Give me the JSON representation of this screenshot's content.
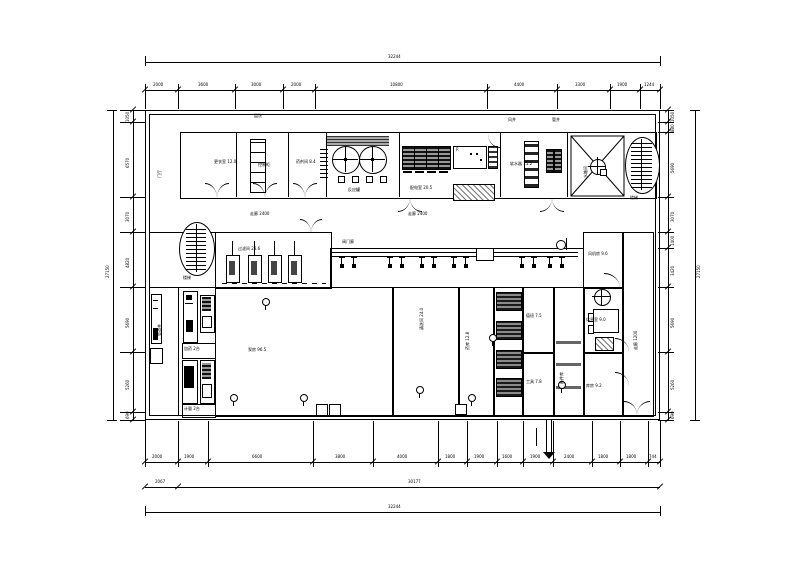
{
  "drawing": {
    "colors": {
      "line": "#000000",
      "hatch_dark": "#444444",
      "hatch_gray": "#999999",
      "fill_black": "#111111"
    },
    "dim_top": {
      "overall": "32244",
      "segments": [
        "2000",
        "3600",
        "3000",
        "2000",
        "10800",
        "4400",
        "3300",
        "1900",
        "1244"
      ]
    },
    "dim_bottom": {
      "overall": "32244",
      "tier2": [
        "2067",
        "30177"
      ],
      "segments": [
        "2000",
        "1900",
        "6600",
        "3800",
        "4000",
        "1800",
        "1900",
        "1600",
        "1900",
        "2400",
        "1800",
        "1800",
        "744"
      ]
    },
    "dim_left": {
      "overall": "27150",
      "segments": [
        "1050",
        "6570",
        "3070",
        "4820",
        "5690",
        "5260",
        "690"
      ]
    },
    "dim_right": {
      "overall": "27150",
      "segments": [
        "1050",
        "880",
        "5690",
        "3070",
        "1400",
        "3420",
        "5690",
        "5260",
        "690"
      ]
    },
    "labels": {
      "t1": "盥洗",
      "t2": "风井",
      "t3": "管井",
      "r1": "更衣室 12.0",
      "r2": "控制柜",
      "r3": "药剂间 8.4",
      "react": "反应罐",
      "power": "配电室 20.5",
      "pdesk": "P.",
      "soft": "软水器 15.2",
      "tankroom": "水箱间",
      "corr1": "走廊 2400",
      "corr2": "走廊 2400",
      "stair1": "楼梯",
      "stair2": "楼梯",
      "filter": "过滤间 28.6",
      "manifold": "阀门廊",
      "fan": "风机房 9.6",
      "rest": "休息室 9.0",
      "store": "库房 9.2",
      "corr3": "走廊 1200",
      "shaft": "管道井",
      "lobby": "门厅",
      "dosing": "加药 2台",
      "meter": "计量 2台",
      "hallA": "泵房 96.5",
      "hallB": "清洗间 24.0",
      "chem": "药库 12.8",
      "duty": "值班 7.5",
      "tool": "工具 7.8",
      "spare": "备件库"
    }
  }
}
